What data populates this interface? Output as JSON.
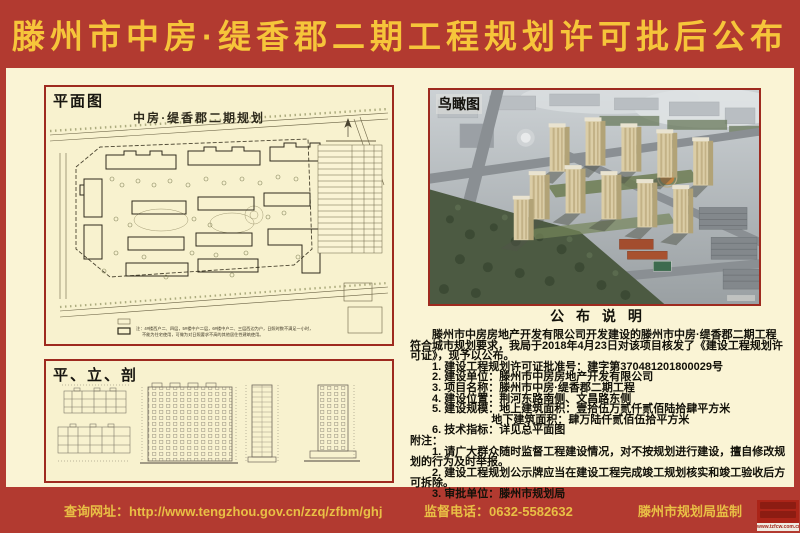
{
  "page": {
    "title": "滕州市中房·缇香郡二期工程规划许可批后公布",
    "colors": {
      "banner_red": "#b23a30",
      "cream": "#faf4d5",
      "gold": "#f6c53a",
      "panel_border_red": "#9e2a1f",
      "ink": "#121109"
    }
  },
  "panels": {
    "site_plan": {
      "label": "平面图",
      "drawing_title": "中房·缇香郡二期规划",
      "note_line1": "注：4#楼西户二、四层，5#楼中户二层，6#楼中户二、三层西边为户，日照时数不满足一小时，",
      "note_line2": "不能为住宅使用，可做为对日照要求不高的其他居住性建筑使用。"
    },
    "plan_elev_section": {
      "label": "平、立、剖"
    },
    "aerial": {
      "label": "鸟瞰图"
    }
  },
  "announcement": {
    "heading": "公 布 说 明",
    "intro": "滕州市中房房地产开发有限公司开发建设的滕州市中房·缇香郡二期工程符合城市规划要求，我局于2018年4月23日对该项目核发了《建设工程规划许可证》，现予以公布。",
    "items": [
      "1. 建设工程规划许可证批准号：建字第370481201800029号",
      "2. 建设单位：滕州市中房房地产开发有限公司",
      "3. 项目名称：滕州市中房·缇香郡二期工程",
      "4. 建设位置：荆河东路南侧、文昌路东侧",
      "5. 建设规模：地上建筑面积：壹拾伍万贰仟贰佰陆拾肆平方米",
      "6. 技术指标：详见总平面图"
    ],
    "item5_sub": "地下建筑面积：肆万陆仟贰佰伍拾平方米",
    "notes_label": "附注：",
    "notes": [
      "1. 请广大群众随时监督工程建设情况，对不按规划进行建设，擅自修改规划的行为及时举报。",
      "2. 建设工程规划公示牌应当在建设工程完成竣工规划核实和竣工验收后方可拆除。",
      "3. 审批单位：滕州市规划局"
    ]
  },
  "footer": {
    "website": "查询网址：http://www.tengzhou.gov.cn/zzq/zfbm/ghj",
    "phone": "监督电话：0632-5582632",
    "producer": "滕州市规划局监制",
    "watermark_url": "www.tzfcw.com.cn"
  }
}
